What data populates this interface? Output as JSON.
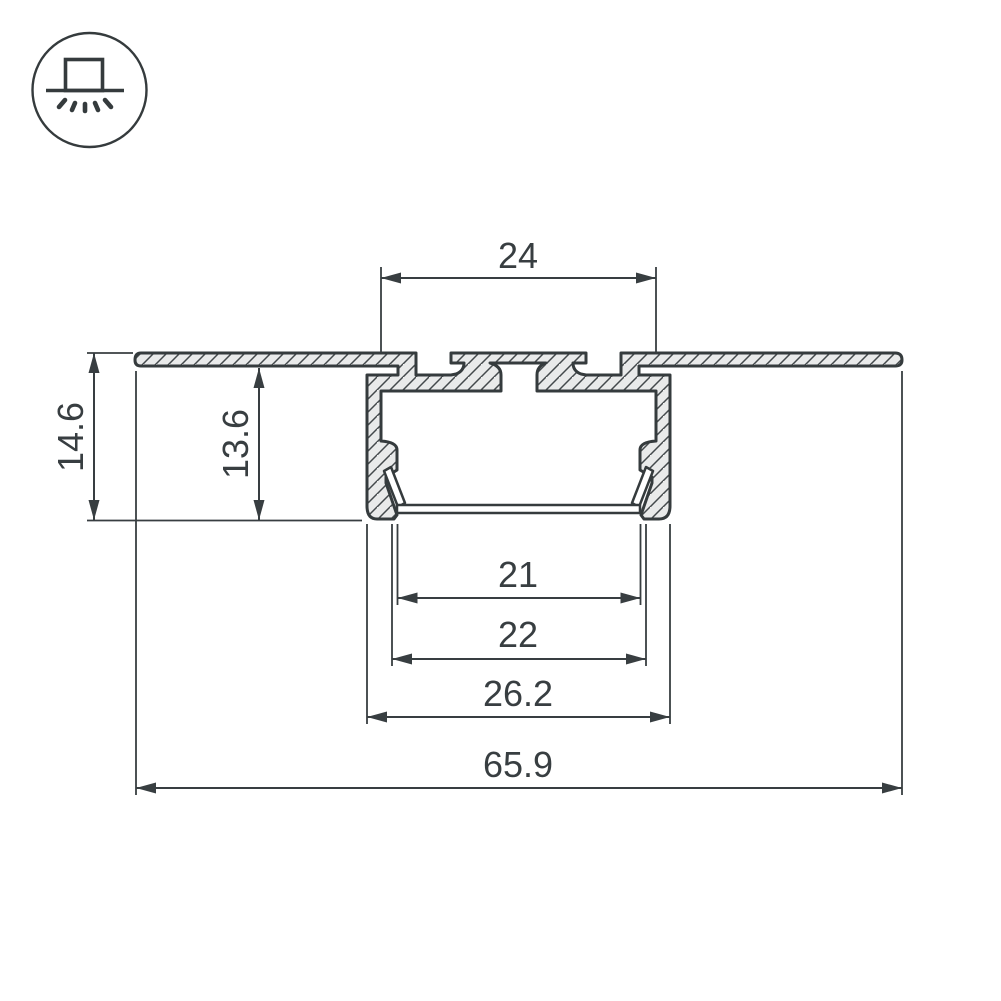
{
  "drawing": {
    "type": "technical-cross-section",
    "subject": "recessed aluminum LED profile with ceiling flange and diffuser",
    "icon": {
      "name": "recessed-mount-icon"
    },
    "dimensions": {
      "top_width": "24",
      "overall_height": "14.6",
      "recess_depth": "13.6",
      "diffuser_inner_width": "21",
      "diffuser_width": "22",
      "body_width": "26.2",
      "flange_width": "65.9"
    },
    "colors": {
      "line": "#353b3d",
      "metal_fill": "#e9eaea",
      "text": "#383e41",
      "background": "#ffffff"
    }
  }
}
